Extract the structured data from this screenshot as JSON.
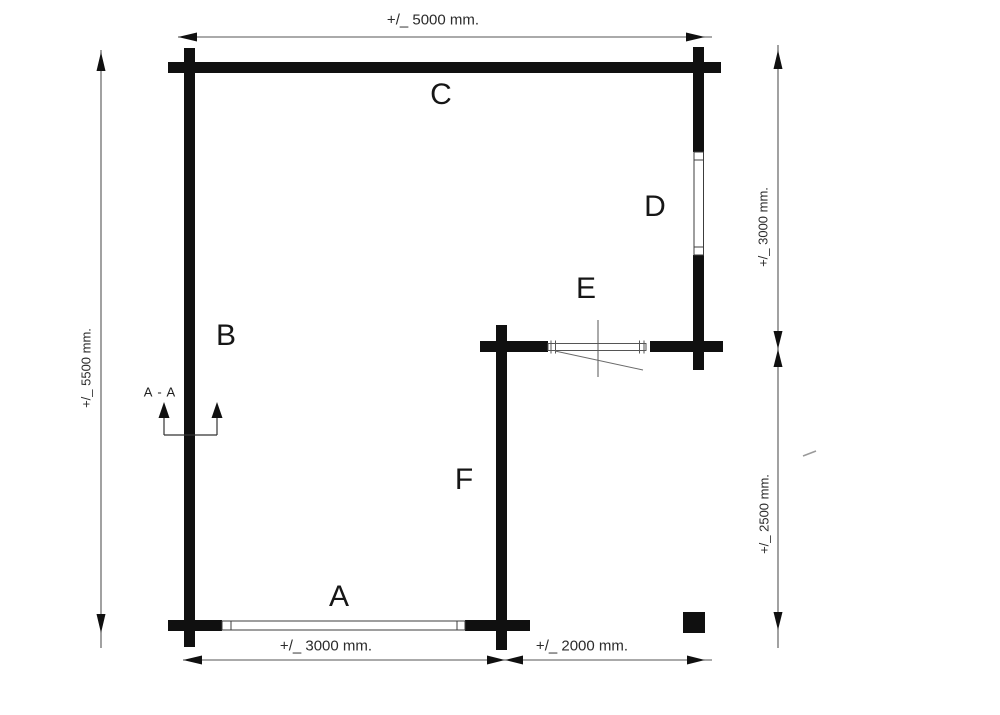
{
  "drawing": {
    "type": "floor-plan",
    "wall_labels": {
      "a": "A",
      "b": "B",
      "c": "C",
      "d": "D",
      "e": "E",
      "f": "F"
    },
    "dimensions": {
      "top": "+/_ 5000 mm.",
      "left": "+/_ 5500 mm.",
      "right_upper": "+/_ 3000 mm.",
      "right_lower": "+/_ 2500 mm.",
      "bottom_left": "+/_ 3000 mm.",
      "bottom_right": "+/_ 2000 mm."
    },
    "section_marker": {
      "label": "A - A"
    },
    "colors": {
      "wall": "#101010",
      "dimension_line": "#555555",
      "window_outline": "#3c3c3c",
      "text": "#2b2b2b",
      "background": "#ffffff"
    }
  }
}
